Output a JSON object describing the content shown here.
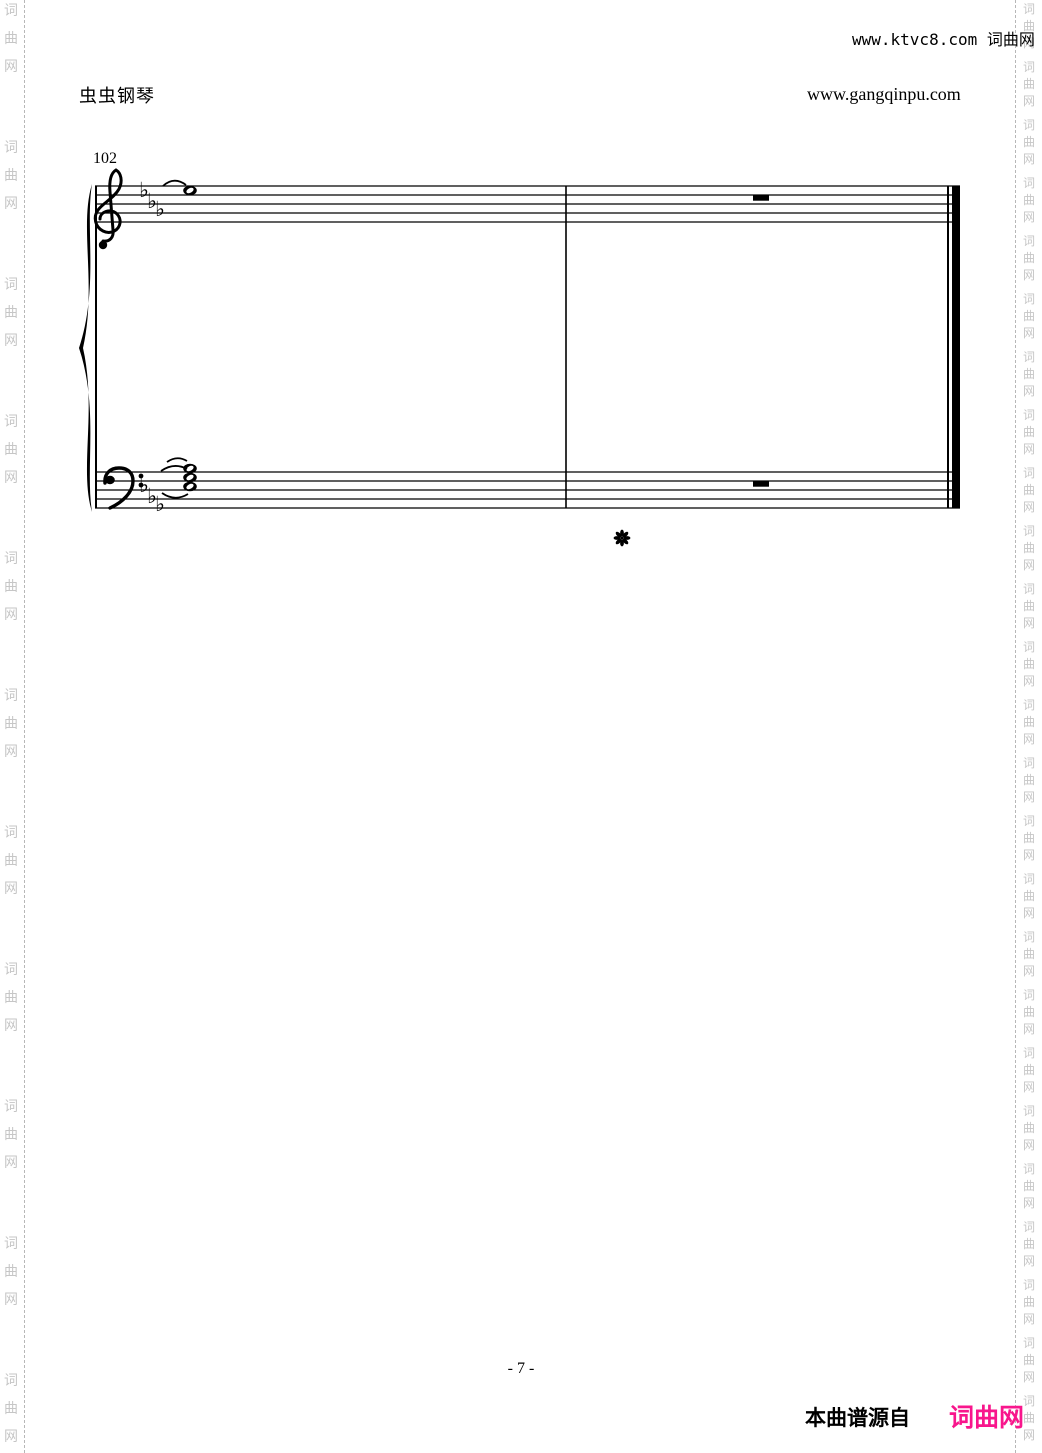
{
  "header": {
    "brand": "虫虫钢琴",
    "site_url": "www.gangqinpu.com",
    "top_credit": "www.ktvc8.com 词曲网"
  },
  "watermark": {
    "text": "词曲网",
    "chars": [
      "词",
      "曲",
      "网"
    ],
    "color": "#c6c6c6"
  },
  "score": {
    "measure_number": "102",
    "key_signature": "E-flat major, 3 flats",
    "flat": "♭",
    "treble_measure_1": "tied whole note (top space)",
    "treble_measure_2": "whole rest",
    "bass_measure_1": "tied whole-note chord (stacked thirds)",
    "bass_measure_2": "whole rest",
    "pedal_mark": "pedal-release asterisk"
  },
  "footer": {
    "page_number": "- 7 -",
    "source_prefix": "本曲谱源自",
    "source_brand": "词曲网",
    "source_brand_color": "#f8168c"
  }
}
